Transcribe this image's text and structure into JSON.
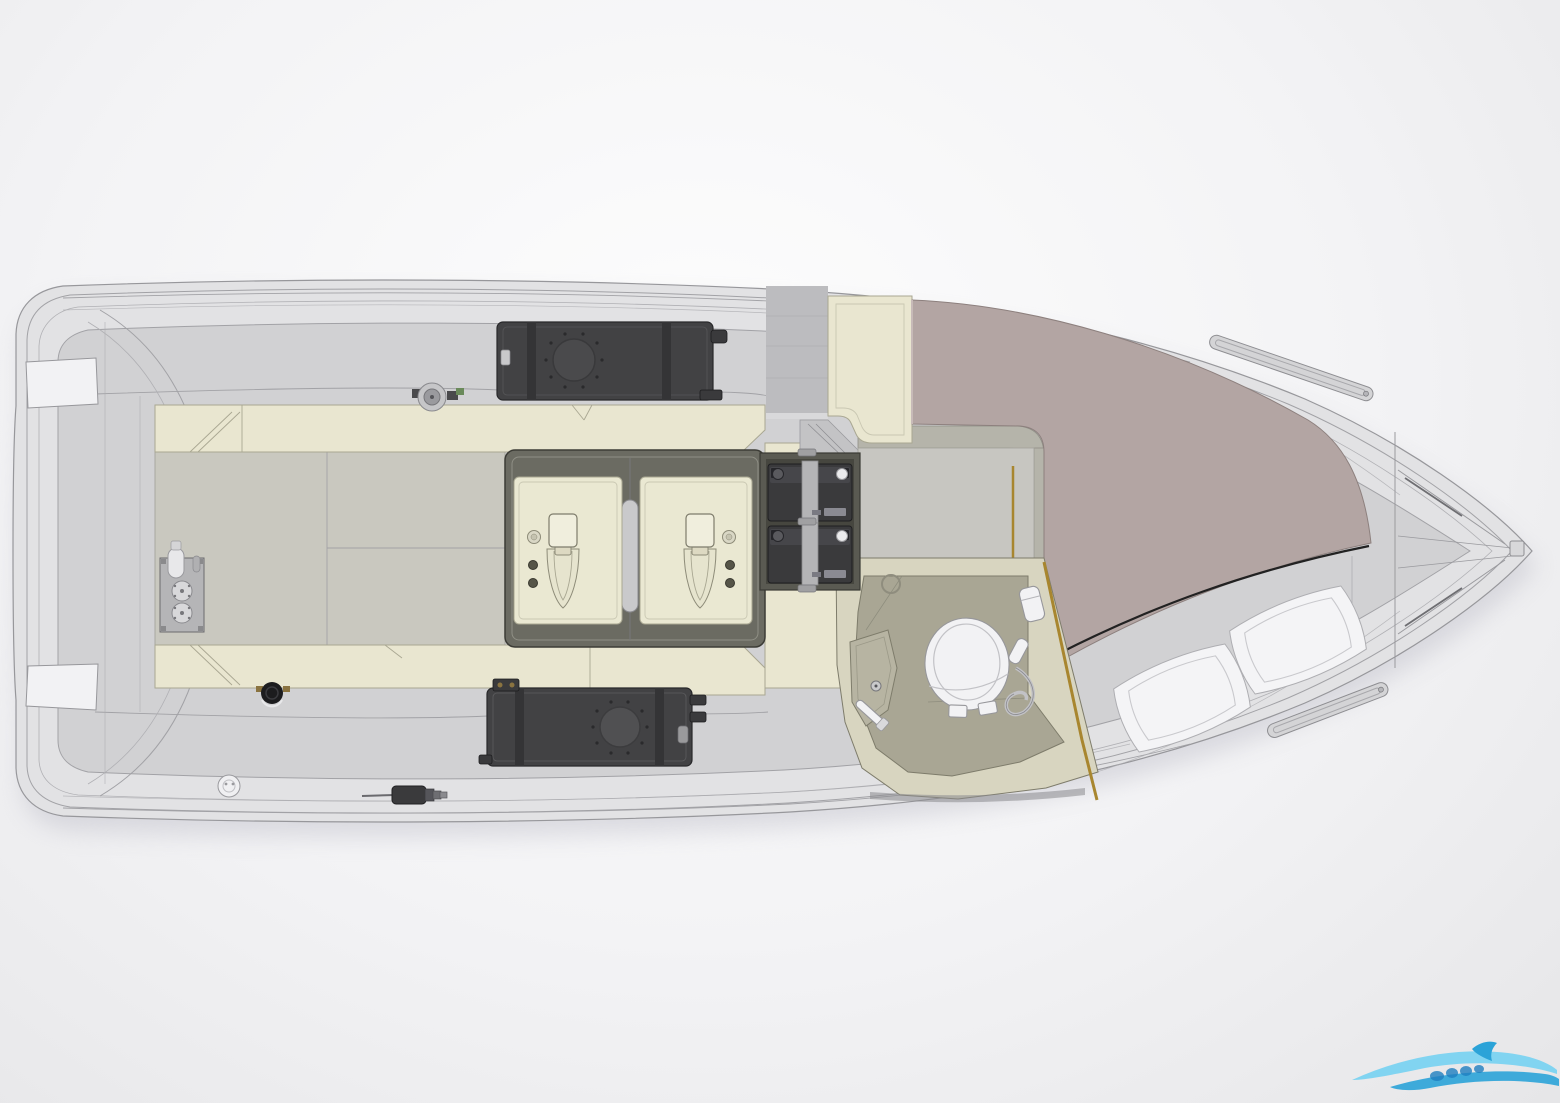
{
  "scene": {
    "kind": "boat-deck-plan-top-view",
    "width_px": 1560,
    "height_px": 1103,
    "orientation": "bow-right"
  },
  "colors": {
    "bg_inner": "#fdfdfd",
    "bg_outer": "#e6e6e8",
    "hull": "#e2e2e4",
    "hull_line": "#97979b",
    "deck": "#d1d1d3",
    "deck_line": "#a2a2a6",
    "deck_warm": "#c9c8bf",
    "cream": "#e9e6d0",
    "cream_edge": "#a9a792",
    "frame_dark": "#6b6b62",
    "frame_stroke": "#3c3c36",
    "panel": "#eae8d2",
    "panel_edge": "#a9a792",
    "tank": "#424244",
    "tank_stroke": "#28282a",
    "strap": "#343436",
    "battery": "#3a3a3c",
    "battery_strap": "#b4b4b6",
    "cabin_floor": "#c7c6c1",
    "wall": "#b5b4aa",
    "wall_line": "#8f8e85",
    "gold": "#a8862f",
    "mauve": "#b3a5a3",
    "mauve_edge": "#8d807e",
    "pillow": "#f4f4f6",
    "pillow_edge": "#aeaeb2",
    "head_wall": "#d8d5c0",
    "head_floor": "#a9a694",
    "head_edge": "#7e7c6b",
    "counter": "#b7b4a2",
    "white_part": "#f2f2f4",
    "part_edge": "#97979b",
    "metal": "#c6c6c8",
    "metal_dark": "#8a8a8e",
    "dark_part": "#3a3a3c",
    "brass": "#8a7340",
    "logo_light": "#6fd0f2",
    "logo_deep": "#2ba3d8",
    "logo_text": "#1f7fc0"
  },
  "parts": [
    "hull",
    "stern-platform-step-top",
    "stern-platform-step-bottom",
    "transom",
    "cockpit-floor",
    "stringer-top",
    "stringer-bottom",
    "tank-port",
    "tank-starboard",
    "water-pump",
    "bilge-pump",
    "engine-hatch-frame",
    "outboard-engine-aft",
    "outboard-engine-forward",
    "battery-compartment",
    "battery-1",
    "battery-2",
    "cabin-floor",
    "companionway-steps",
    "door-trim-gold",
    "head-compartment",
    "toilet",
    "sink-counter",
    "faucet",
    "shower-wand",
    "wall-dispenser",
    "bow-berth-mattress",
    "pillow-left",
    "pillow-right",
    "handrail-port",
    "handrail-starboard",
    "bow-locker-lines",
    "deck-drain",
    "scupper-fitting",
    "seacock-manifold",
    "wave-logo-watermark"
  ],
  "watermark": {
    "icon": "wave-swoosh-logo",
    "position": "bottom-right",
    "colors": [
      "#6fd0f2",
      "#2ba3d8",
      "#1f7fc0"
    ]
  }
}
